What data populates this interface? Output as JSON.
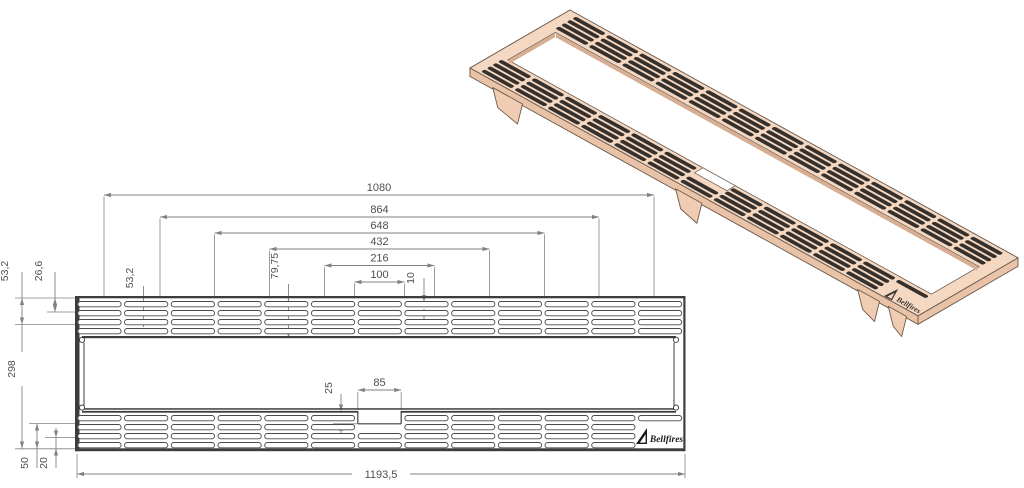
{
  "drawing2d": {
    "top_dims": [
      "1080",
      "864",
      "648",
      "432",
      "216",
      "100"
    ],
    "slot_pitch_dim": "10",
    "left_dims": {
      "band": "53,2",
      "row": "26,6",
      "height": "298",
      "bottom_band": "50",
      "bottom_row": "20"
    },
    "inner_dims": {
      "band": "53,2",
      "opening": "79,75"
    },
    "notch": {
      "width": "85",
      "depth": "25"
    },
    "overall_length": "1193,5",
    "logo_text": "Bellfires"
  },
  "view3d": {
    "logo_text": "Bellfires"
  },
  "colors": {
    "part_face": "#f4d8c2",
    "part_side": "#e9c3a7",
    "part_foot": "#f0cdb2",
    "part_wall": "#d8ae93",
    "slot_3d": "#36302c",
    "outline_3d": "#6d5b4e",
    "part_line": "#3d3d3d",
    "slot_line": "#4a4a4a",
    "dim_line": "#828282",
    "dim_text": "#4f4f4f",
    "logo": "#1a1a1a"
  }
}
